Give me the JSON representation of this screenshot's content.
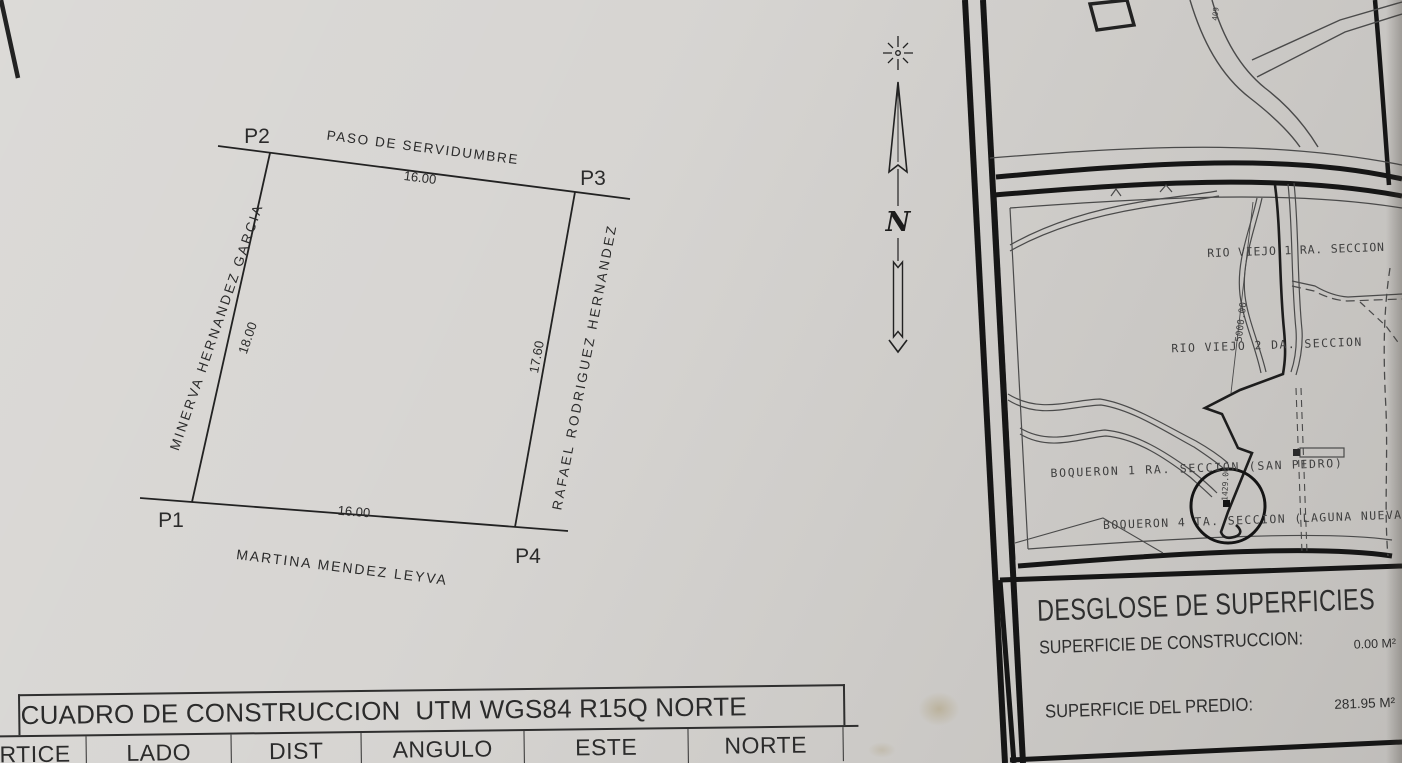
{
  "plot": {
    "p1": "P1",
    "p2": "P2",
    "p3": "P3",
    "p4": "P4",
    "side_top_name": "PASO DE SERVIDUMBRE",
    "side_top_dist": "16.00",
    "side_left_name": "MINERVA HERNANDEZ GARCIA",
    "side_left_dist": "18.00",
    "side_right_name": "RAFAEL RODRIGUEZ HERNANDEZ",
    "side_right_dist": "17.60",
    "side_bottom_name": "MARTINA MENDEZ LEYVA",
    "side_bottom_dist": "16.00"
  },
  "north": {
    "letter": "N"
  },
  "map": {
    "rio1": "RIO VIEJO 1 RA. SECCION",
    "rio2": "RIO VIEJO 2 DA. SECCION",
    "boq1": "BOQUERON 1 RA. SECCION (SAN PEDRO)",
    "boq4": "BOQUERON 4 TA. SECCION (LAGUNA NUEVA",
    "dim_5000": "5000.00",
    "dim_1429": "1429.00",
    "road_409": "409"
  },
  "surfaces": {
    "title": "DESGLOSE DE SUPERFICIES",
    "construction_label": "SUPERFICIE DE CONSTRUCCION:",
    "construction_value": "0.00 M²",
    "predio_label": "SUPERFICIE DEL PREDIO:",
    "predio_value": "281.95 M²"
  },
  "table": {
    "title": "CUADRO DE CONSTRUCCION  UTM WGS84 R15Q NORTE",
    "headers": [
      "VERTICE",
      "LADO",
      "DIST",
      "ANGULO",
      "ESTE",
      "NORTE"
    ]
  },
  "colors": {
    "ink": "#222222",
    "paper": "#d5d3d0",
    "frame": "#161616"
  }
}
